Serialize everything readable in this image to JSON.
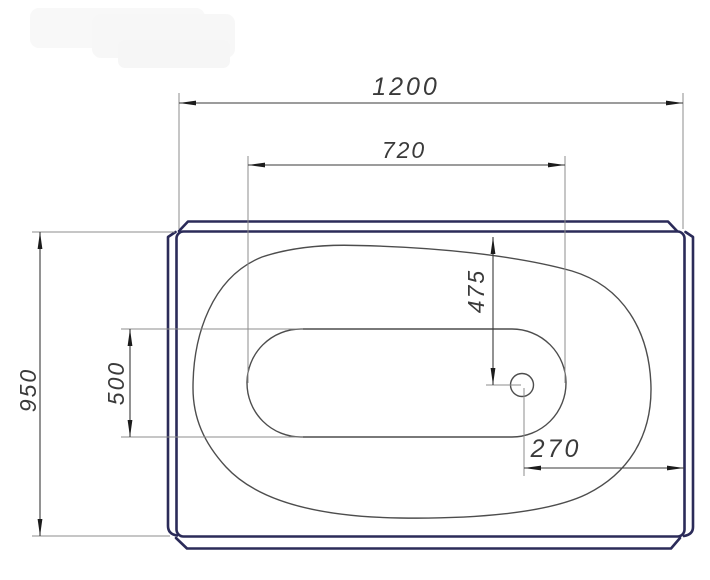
{
  "dimensions": {
    "overall_width": "1200",
    "basin_floor_width": "720",
    "overall_depth": "950",
    "basin_floor_depth": "500",
    "drain_offset_from_top": "475",
    "drain_offset_from_right": "270"
  },
  "colors": {
    "background": "#ffffff",
    "shell_outline": "#2b2b59",
    "contour_line": "#4d4d4d",
    "dimension_line": "#3a3a3a",
    "extension_line": "#8c8c8c",
    "arrow": "#1c1c1c",
    "label_text": "#3a3a3a",
    "watermark": "#f6f6f6"
  }
}
